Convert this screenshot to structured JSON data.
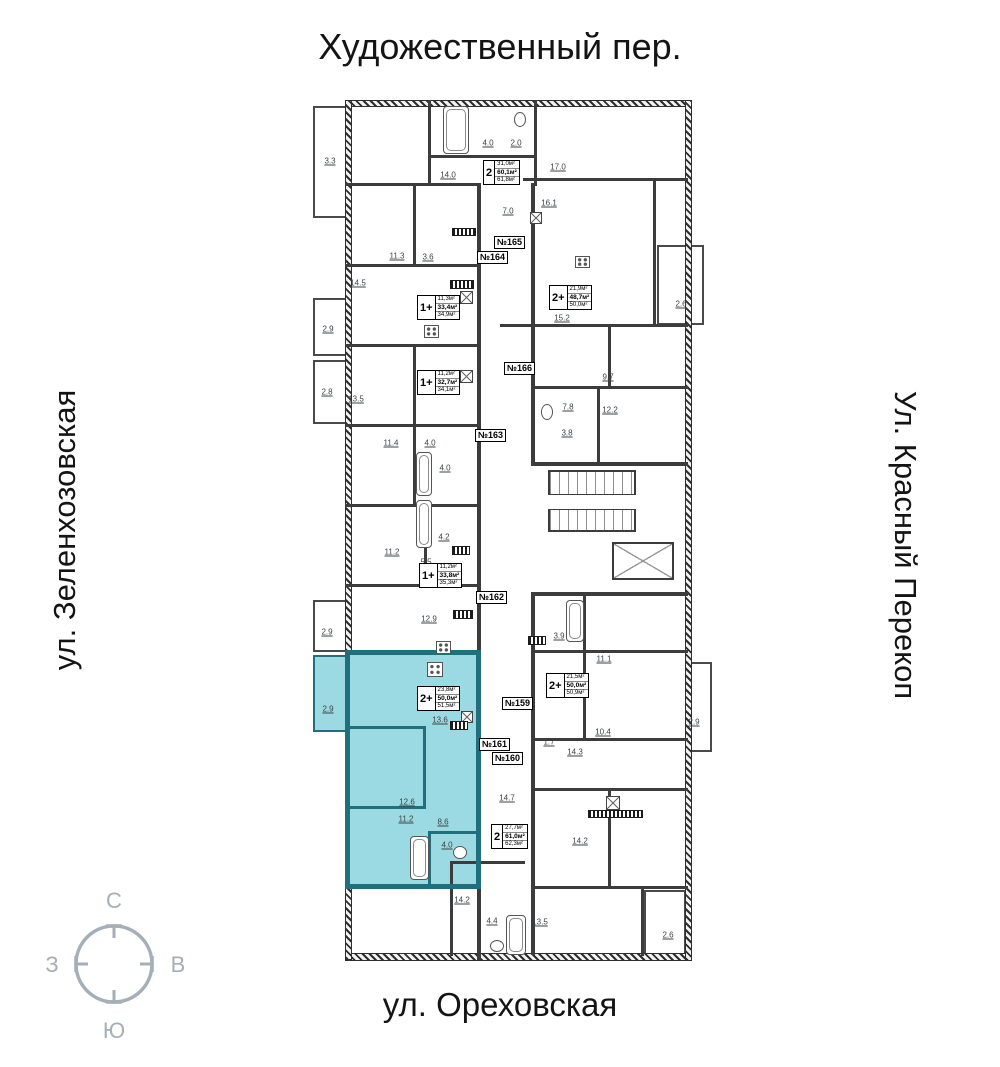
{
  "streets": {
    "top": "Художественный пер.",
    "left": "ул. Зеленхозовская",
    "right": "Ул. Красный Перекоп",
    "bottom": "ул. Ореховская"
  },
  "compass": {
    "north": "С",
    "south": "Ю",
    "west": "З",
    "east": "В"
  },
  "colors": {
    "highlight_fill": "#9bd9e3",
    "highlight_wall": "#1f6f7c",
    "wall": "#3c3c3c",
    "compass": "#a6aeb8"
  },
  "apartment_tags": [
    {
      "label": "№165",
      "x": 494,
      "y": 236
    },
    {
      "label": "№164",
      "x": 477,
      "y": 251
    },
    {
      "label": "№166",
      "x": 504,
      "y": 362
    },
    {
      "label": "№163",
      "x": 475,
      "y": 429
    },
    {
      "label": "№162",
      "x": 476,
      "y": 591
    },
    {
      "label": "№159",
      "x": 502,
      "y": 697
    },
    {
      "label": "№161",
      "x": 479,
      "y": 738
    },
    {
      "label": "№160",
      "x": 492,
      "y": 752
    }
  ],
  "units": [
    {
      "type": "2",
      "a1": "31,0м²",
      "a2": "60,1м²",
      "a3": "61,8м²",
      "x": 483,
      "y": 160,
      "highlight": false
    },
    {
      "type": "1+",
      "a1": "11,3м²",
      "a2": "33,4м²",
      "a3": "34,9м²",
      "x": 417,
      "y": 295,
      "highlight": false
    },
    {
      "type": "2+",
      "a1": "21,9м²",
      "a2": "48,7м²",
      "a3": "50,0м²",
      "x": 549,
      "y": 285,
      "highlight": false
    },
    {
      "type": "1+",
      "a1": "11,2м²",
      "a2": "32,7м²",
      "a3": "34,1м²",
      "x": 417,
      "y": 370,
      "highlight": false
    },
    {
      "type": "1+",
      "a1": "11,2м²",
      "a2": "33,8м²",
      "a3": "35,3м²",
      "x": 419,
      "y": 563,
      "highlight": false
    },
    {
      "type": "2+",
      "a1": "23,8м²",
      "a2": "50,0м²",
      "a3": "51,5м²",
      "x": 417,
      "y": 686,
      "highlight": true
    },
    {
      "type": "2+",
      "a1": "21,5м²",
      "a2": "50,0м²",
      "a3": "50,9м²",
      "x": 546,
      "y": 673,
      "highlight": false
    },
    {
      "type": "2",
      "a1": "27,7м²",
      "a2": "61,0м²",
      "a3": "62,3м²",
      "x": 491,
      "y": 824,
      "highlight": false
    }
  ],
  "room_labels": [
    {
      "v": "3.3",
      "x": 330,
      "y": 161
    },
    {
      "v": "14.0",
      "x": 448,
      "y": 175
    },
    {
      "v": "4.0",
      "x": 488,
      "y": 143
    },
    {
      "v": "2.0",
      "x": 516,
      "y": 143
    },
    {
      "v": "17.0",
      "x": 558,
      "y": 167
    },
    {
      "v": "16.1",
      "x": 549,
      "y": 203
    },
    {
      "v": "7.0",
      "x": 508,
      "y": 211
    },
    {
      "v": "11.3",
      "x": 397,
      "y": 256
    },
    {
      "v": "3.6",
      "x": 428,
      "y": 257
    },
    {
      "v": "14.5",
      "x": 358,
      "y": 283
    },
    {
      "v": "2.9",
      "x": 328,
      "y": 329
    },
    {
      "v": "15.2",
      "x": 562,
      "y": 318
    },
    {
      "v": "2.6",
      "x": 681,
      "y": 304
    },
    {
      "v": "2.8",
      "x": 327,
      "y": 392
    },
    {
      "v": "13.5",
      "x": 356,
      "y": 399
    },
    {
      "v": "9.7",
      "x": 608,
      "y": 377
    },
    {
      "v": "7.8",
      "x": 568,
      "y": 407
    },
    {
      "v": "12.2",
      "x": 610,
      "y": 410
    },
    {
      "v": "3.8",
      "x": 567,
      "y": 433
    },
    {
      "v": "11.4",
      "x": 391,
      "y": 443
    },
    {
      "v": "4.0",
      "x": 430,
      "y": 443
    },
    {
      "v": "4.0",
      "x": 445,
      "y": 468
    },
    {
      "v": "4.2",
      "x": 444,
      "y": 537
    },
    {
      "v": "11.2",
      "x": 392,
      "y": 552
    },
    {
      "v": "5.5",
      "x": 426,
      "y": 562
    },
    {
      "v": "12.9",
      "x": 429,
      "y": 619
    },
    {
      "v": "2.9",
      "x": 327,
      "y": 632
    },
    {
      "v": "2.9",
      "x": 328,
      "y": 709
    },
    {
      "v": "13.6",
      "x": 440,
      "y": 720
    },
    {
      "v": "12.6",
      "x": 407,
      "y": 802
    },
    {
      "v": "11.2",
      "x": 406,
      "y": 819
    },
    {
      "v": "8.6",
      "x": 443,
      "y": 822
    },
    {
      "v": "4.0",
      "x": 447,
      "y": 845
    },
    {
      "v": "3.9",
      "x": 559,
      "y": 636
    },
    {
      "v": "11.1",
      "x": 604,
      "y": 659
    },
    {
      "v": "10.4",
      "x": 603,
      "y": 732
    },
    {
      "v": "1.7",
      "x": 549,
      "y": 742
    },
    {
      "v": "14.3",
      "x": 575,
      "y": 752
    },
    {
      "v": "2.9",
      "x": 694,
      "y": 722
    },
    {
      "v": "14.7",
      "x": 507,
      "y": 798
    },
    {
      "v": "14.2",
      "x": 580,
      "y": 841
    },
    {
      "v": "14.2",
      "x": 462,
      "y": 900
    },
    {
      "v": "4.4",
      "x": 492,
      "y": 921
    },
    {
      "v": "13.5",
      "x": 540,
      "y": 922
    },
    {
      "v": "2.6",
      "x": 668,
      "y": 935
    }
  ]
}
